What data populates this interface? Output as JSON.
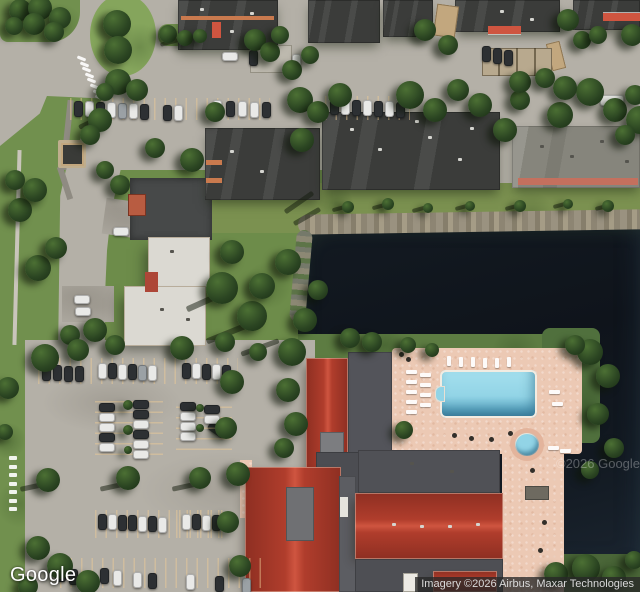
{
  "branding": {
    "logo": "Google"
  },
  "attribution": {
    "text": "Imagery ©2026 Airbus, Maxar Technologies"
  },
  "watermark": {
    "text": "©2026 Google"
  },
  "colors": {
    "asphalt": "#b4b0a7",
    "road": "#b8b4ab",
    "asphalt_dark": "#474949",
    "grass": "#71904e",
    "grass_dark": "#58793f",
    "grass_olive": "#7b9150",
    "grass_deep": "#4a6638",
    "water": "#10151c",
    "shore": "#968f7d",
    "roof_dark": "#3b3c3a",
    "roof_gray": "#86857c",
    "roof_light": "#dbd9d2",
    "flat_gray": "#53545a",
    "roof_red": "#b03d2c",
    "roof_red_dark": "#8e2f22",
    "roof_red_light": "#cf5540",
    "deck": "#ecc9b4",
    "pool": "#92d4e6",
    "pool_deep": "#4f96b4",
    "tree": "#2b4522",
    "tree_light": "#4c7034",
    "tree_dark": "#1c3116",
    "car_white": "#e9e9e7",
    "car_dark": "#2d3033",
    "car_silver": "#9ba1a5",
    "trim_orange": "#c97a4e",
    "trim_red": "#c4705e",
    "white": "#ffffff",
    "item_dark": "#322f2a"
  },
  "scene": {
    "trees": [
      [
        20,
        10,
        11
      ],
      [
        40,
        8,
        12
      ],
      [
        60,
        18,
        11
      ],
      [
        34,
        24,
        11
      ],
      [
        54,
        32,
        10
      ],
      [
        14,
        26,
        9
      ],
      [
        117,
        24,
        14
      ],
      [
        118,
        50,
        14
      ],
      [
        168,
        34,
        9
      ],
      [
        185,
        38,
        8
      ],
      [
        200,
        36,
        7
      ],
      [
        255,
        40,
        11
      ],
      [
        270,
        52,
        10
      ],
      [
        280,
        35,
        9
      ],
      [
        118,
        82,
        13
      ],
      [
        137,
        90,
        11
      ],
      [
        105,
        92,
        9
      ],
      [
        300,
        100,
        13
      ],
      [
        318,
        112,
        11
      ],
      [
        340,
        95,
        12
      ],
      [
        292,
        70,
        10
      ],
      [
        310,
        55,
        9
      ],
      [
        425,
        30,
        11
      ],
      [
        448,
        45,
        10
      ],
      [
        568,
        20,
        11
      ],
      [
        582,
        40,
        9
      ],
      [
        632,
        35,
        11
      ],
      [
        598,
        35,
        9
      ],
      [
        410,
        95,
        14
      ],
      [
        435,
        110,
        12
      ],
      [
        458,
        90,
        11
      ],
      [
        480,
        105,
        12
      ],
      [
        505,
        130,
        12
      ],
      [
        520,
        100,
        10
      ],
      [
        560,
        115,
        13
      ],
      [
        590,
        92,
        14
      ],
      [
        615,
        110,
        12
      ],
      [
        635,
        95,
        10
      ],
      [
        565,
        88,
        12
      ],
      [
        520,
        82,
        11
      ],
      [
        545,
        78,
        10
      ],
      [
        640,
        120,
        14
      ],
      [
        625,
        135,
        10
      ],
      [
        302,
        140,
        12
      ],
      [
        215,
        112,
        10
      ],
      [
        192,
        160,
        12
      ],
      [
        155,
        148,
        10
      ],
      [
        348,
        207,
        6
      ],
      [
        388,
        204,
        6
      ],
      [
        428,
        208,
        5
      ],
      [
        470,
        206,
        5
      ],
      [
        520,
        206,
        6
      ],
      [
        568,
        204,
        5
      ],
      [
        608,
        206,
        6
      ],
      [
        222,
        288,
        16
      ],
      [
        252,
        316,
        15
      ],
      [
        288,
        262,
        13
      ],
      [
        232,
        252,
        12
      ],
      [
        262,
        286,
        13
      ],
      [
        305,
        320,
        12
      ],
      [
        318,
        290,
        10
      ],
      [
        38,
        268,
        13
      ],
      [
        56,
        248,
        11
      ],
      [
        20,
        210,
        12
      ],
      [
        35,
        190,
        12
      ],
      [
        15,
        180,
        10
      ],
      [
        100,
        120,
        12
      ],
      [
        90,
        135,
        10
      ],
      [
        120,
        185,
        10
      ],
      [
        105,
        170,
        9
      ],
      [
        95,
        330,
        12
      ],
      [
        70,
        335,
        10
      ],
      [
        115,
        345,
        10
      ],
      [
        292,
        352,
        14
      ],
      [
        288,
        390,
        12
      ],
      [
        296,
        424,
        12
      ],
      [
        284,
        448,
        10
      ],
      [
        404,
        430,
        9
      ],
      [
        372,
        342,
        10
      ],
      [
        350,
        338,
        10
      ],
      [
        408,
        345,
        8
      ],
      [
        432,
        350,
        7
      ],
      [
        590,
        352,
        13
      ],
      [
        608,
        376,
        12
      ],
      [
        598,
        414,
        11
      ],
      [
        614,
        448,
        10
      ],
      [
        590,
        470,
        9
      ],
      [
        575,
        345,
        10
      ],
      [
        556,
        574,
        12
      ],
      [
        586,
        568,
        14
      ],
      [
        614,
        578,
        12
      ],
      [
        634,
        560,
        9
      ],
      [
        45,
        358,
        14
      ],
      [
        78,
        350,
        11
      ],
      [
        182,
        348,
        12
      ],
      [
        225,
        342,
        10
      ],
      [
        258,
        352,
        9
      ],
      [
        48,
        480,
        12
      ],
      [
        128,
        478,
        12
      ],
      [
        200,
        478,
        11
      ],
      [
        38,
        548,
        12
      ],
      [
        60,
        566,
        13
      ],
      [
        88,
        582,
        12
      ],
      [
        28,
        586,
        10
      ],
      [
        232,
        382,
        12
      ],
      [
        226,
        428,
        11
      ],
      [
        238,
        474,
        12
      ],
      [
        228,
        522,
        11
      ],
      [
        240,
        566,
        11
      ],
      [
        8,
        388,
        11
      ],
      [
        5,
        432,
        8
      ],
      [
        128,
        405,
        5
      ],
      [
        128,
        430,
        5
      ],
      [
        128,
        450,
        4
      ],
      [
        200,
        408,
        4
      ],
      [
        200,
        428,
        4
      ]
    ],
    "cars": [
      [
        222,
        52,
        "h",
        "w"
      ],
      [
        249,
        50,
        "v",
        "d"
      ],
      [
        292,
        54,
        "v",
        "w"
      ],
      [
        482,
        46,
        "v",
        "d"
      ],
      [
        493,
        48,
        "v",
        "d"
      ],
      [
        504,
        50,
        "v",
        "d"
      ],
      [
        74,
        101,
        "v",
        "d"
      ],
      [
        85,
        101,
        "v",
        "w"
      ],
      [
        96,
        102,
        "v",
        "d"
      ],
      [
        107,
        102,
        "v",
        "w"
      ],
      [
        118,
        103,
        "v",
        "s"
      ],
      [
        129,
        103,
        "v",
        "w"
      ],
      [
        140,
        104,
        "v",
        "d"
      ],
      [
        163,
        105,
        "v",
        "d"
      ],
      [
        174,
        105,
        "v",
        "w"
      ],
      [
        213,
        100,
        "v",
        "w"
      ],
      [
        226,
        101,
        "v",
        "d"
      ],
      [
        238,
        101,
        "v",
        "w"
      ],
      [
        250,
        102,
        "v",
        "w"
      ],
      [
        262,
        102,
        "v",
        "d"
      ],
      [
        330,
        99,
        "v",
        "d"
      ],
      [
        341,
        99,
        "v",
        "w"
      ],
      [
        352,
        100,
        "v",
        "d"
      ],
      [
        363,
        100,
        "v",
        "w"
      ],
      [
        374,
        101,
        "v",
        "d"
      ],
      [
        385,
        101,
        "v",
        "w"
      ],
      [
        396,
        102,
        "v",
        "d"
      ],
      [
        113,
        227,
        "h",
        "w"
      ],
      [
        74,
        295,
        "h",
        "w"
      ],
      [
        75,
        307,
        "h",
        "w"
      ],
      [
        42,
        365,
        "v",
        "d"
      ],
      [
        53,
        365,
        "v",
        "d"
      ],
      [
        64,
        366,
        "v",
        "d"
      ],
      [
        75,
        366,
        "v",
        "d"
      ],
      [
        98,
        363,
        "v",
        "w"
      ],
      [
        108,
        363,
        "v",
        "d"
      ],
      [
        118,
        364,
        "v",
        "w"
      ],
      [
        128,
        364,
        "v",
        "d"
      ],
      [
        138,
        365,
        "v",
        "s"
      ],
      [
        148,
        365,
        "v",
        "w"
      ],
      [
        182,
        363,
        "v",
        "d"
      ],
      [
        192,
        363,
        "v",
        "w"
      ],
      [
        202,
        364,
        "v",
        "d"
      ],
      [
        212,
        364,
        "v",
        "w"
      ],
      [
        222,
        365,
        "v",
        "d"
      ],
      [
        99,
        403,
        "h",
        "d"
      ],
      [
        99,
        413,
        "h",
        "w"
      ],
      [
        99,
        423,
        "h",
        "w"
      ],
      [
        99,
        433,
        "h",
        "d"
      ],
      [
        99,
        443,
        "h",
        "w"
      ],
      [
        133,
        400,
        "h",
        "d"
      ],
      [
        133,
        410,
        "h",
        "d"
      ],
      [
        133,
        420,
        "h",
        "w"
      ],
      [
        133,
        430,
        "h",
        "d"
      ],
      [
        133,
        440,
        "h",
        "w"
      ],
      [
        133,
        450,
        "h",
        "w"
      ],
      [
        180,
        402,
        "h",
        "d"
      ],
      [
        180,
        412,
        "h",
        "w"
      ],
      [
        180,
        422,
        "h",
        "w"
      ],
      [
        180,
        432,
        "h",
        "w"
      ],
      [
        204,
        405,
        "h",
        "d"
      ],
      [
        204,
        415,
        "h",
        "w"
      ],
      [
        98,
        514,
        "v",
        "d"
      ],
      [
        108,
        514,
        "v",
        "w"
      ],
      [
        118,
        515,
        "v",
        "d"
      ],
      [
        128,
        515,
        "v",
        "d"
      ],
      [
        138,
        516,
        "v",
        "w"
      ],
      [
        148,
        516,
        "v",
        "d"
      ],
      [
        158,
        517,
        "v",
        "w"
      ],
      [
        182,
        514,
        "v",
        "w"
      ],
      [
        192,
        514,
        "v",
        "d"
      ],
      [
        202,
        515,
        "v",
        "w"
      ],
      [
        212,
        515,
        "v",
        "d"
      ],
      [
        57,
        566,
        "v",
        "d"
      ],
      [
        69,
        569,
        "v",
        "d"
      ],
      [
        100,
        568,
        "v",
        "d"
      ],
      [
        113,
        570,
        "v",
        "w"
      ],
      [
        133,
        572,
        "v",
        "w"
      ],
      [
        148,
        573,
        "v",
        "d"
      ],
      [
        186,
        574,
        "v",
        "w"
      ],
      [
        215,
        576,
        "v",
        "d"
      ],
      [
        242,
        578,
        "v",
        "s"
      ]
    ],
    "chairs": [
      [
        406,
        370,
        "h"
      ],
      [
        406,
        380,
        "h"
      ],
      [
        406,
        390,
        "h"
      ],
      [
        406,
        400,
        "h"
      ],
      [
        406,
        410,
        "h"
      ],
      [
        420,
        373,
        "h"
      ],
      [
        420,
        383,
        "h"
      ],
      [
        420,
        393,
        "h"
      ],
      [
        420,
        403,
        "h"
      ],
      [
        447,
        356,
        "v"
      ],
      [
        459,
        357,
        "v"
      ],
      [
        471,
        357,
        "v"
      ],
      [
        483,
        358,
        "v"
      ],
      [
        495,
        358,
        "v"
      ],
      [
        507,
        357,
        "v"
      ],
      [
        549,
        390,
        "h"
      ],
      [
        552,
        402,
        "h"
      ],
      [
        548,
        446,
        "h"
      ],
      [
        560,
        449,
        "h"
      ]
    ],
    "dots": [
      [
        452,
        433
      ],
      [
        469,
        436
      ],
      [
        489,
        437
      ],
      [
        508,
        431
      ],
      [
        530,
        468
      ],
      [
        542,
        520
      ],
      [
        538,
        548
      ],
      [
        399,
        352
      ],
      [
        406,
        357
      ],
      [
        70,
        326
      ]
    ],
    "vents": [
      [
        350,
        128,
        "w"
      ],
      [
        378,
        148,
        "w"
      ],
      [
        428,
        136,
        "w"
      ],
      [
        458,
        158,
        "w"
      ],
      [
        415,
        120,
        "w"
      ],
      [
        470,
        127,
        "w"
      ],
      [
        230,
        150,
        "w"
      ],
      [
        260,
        170,
        "w"
      ],
      [
        295,
        140,
        "w"
      ],
      [
        392,
        523,
        "w"
      ],
      [
        420,
        525,
        "w"
      ],
      [
        448,
        525,
        "w"
      ],
      [
        476,
        523,
        "w"
      ],
      [
        200,
        8,
        "w"
      ],
      [
        230,
        30,
        "w"
      ],
      [
        250,
        12,
        "w"
      ],
      [
        500,
        10,
        "w"
      ],
      [
        530,
        18,
        "w"
      ],
      [
        170,
        250,
        "d"
      ],
      [
        186,
        318,
        "d"
      ],
      [
        160,
        308,
        "d"
      ],
      [
        540,
        145,
        "d"
      ],
      [
        570,
        155,
        "d"
      ],
      [
        600,
        140,
        "d"
      ],
      [
        625,
        160,
        "d"
      ],
      [
        450,
        470,
        "d"
      ],
      [
        410,
        462,
        "d"
      ]
    ],
    "streaks": [
      [
        20,
        484,
        28,
        5,
        -12
      ],
      [
        100,
        484,
        26,
        5,
        -12
      ],
      [
        172,
        484,
        26,
        5,
        -12
      ],
      [
        185,
        298,
        42,
        6,
        -24
      ],
      [
        205,
        330,
        46,
        6,
        -22
      ],
      [
        240,
        345,
        40,
        5,
        -20
      ],
      [
        282,
        200,
        34,
        5,
        -35
      ],
      [
        292,
        214,
        30,
        5,
        -30
      ],
      [
        332,
        206,
        18,
        4,
        -15
      ],
      [
        372,
        204,
        18,
        4,
        -15
      ],
      [
        412,
        207,
        16,
        4,
        -15
      ],
      [
        455,
        205,
        16,
        4,
        -15
      ],
      [
        505,
        205,
        16,
        4,
        -15
      ],
      [
        553,
        203,
        16,
        4,
        -15
      ],
      [
        595,
        205,
        16,
        4,
        -15
      ],
      [
        160,
        40,
        22,
        4,
        -15
      ],
      [
        78,
        120,
        24,
        5,
        -25
      ]
    ],
    "stall_bands": [
      [
        70,
        98,
        200,
        22,
        "v"
      ],
      [
        325,
        96,
        85,
        24,
        "v"
      ],
      [
        38,
        358,
        200,
        26,
        "v"
      ],
      [
        95,
        400,
        68,
        55,
        "h"
      ],
      [
        176,
        400,
        56,
        50,
        "h"
      ],
      [
        95,
        510,
        130,
        28,
        "v"
      ],
      [
        176,
        510,
        48,
        28,
        "v"
      ],
      [
        60,
        558,
        210,
        30,
        "v"
      ]
    ],
    "dash_groups": [
      {
        "x": 77,
        "y": 57,
        "dx": 2.6,
        "dy": 5.6,
        "n": 8,
        "w": 9,
        "h": 3,
        "rot": 22
      },
      {
        "x": 9,
        "y": 456,
        "dx": 0,
        "dy": 8.5,
        "n": 7,
        "w": 8,
        "h": 4,
        "rot": 0
      }
    ]
  }
}
